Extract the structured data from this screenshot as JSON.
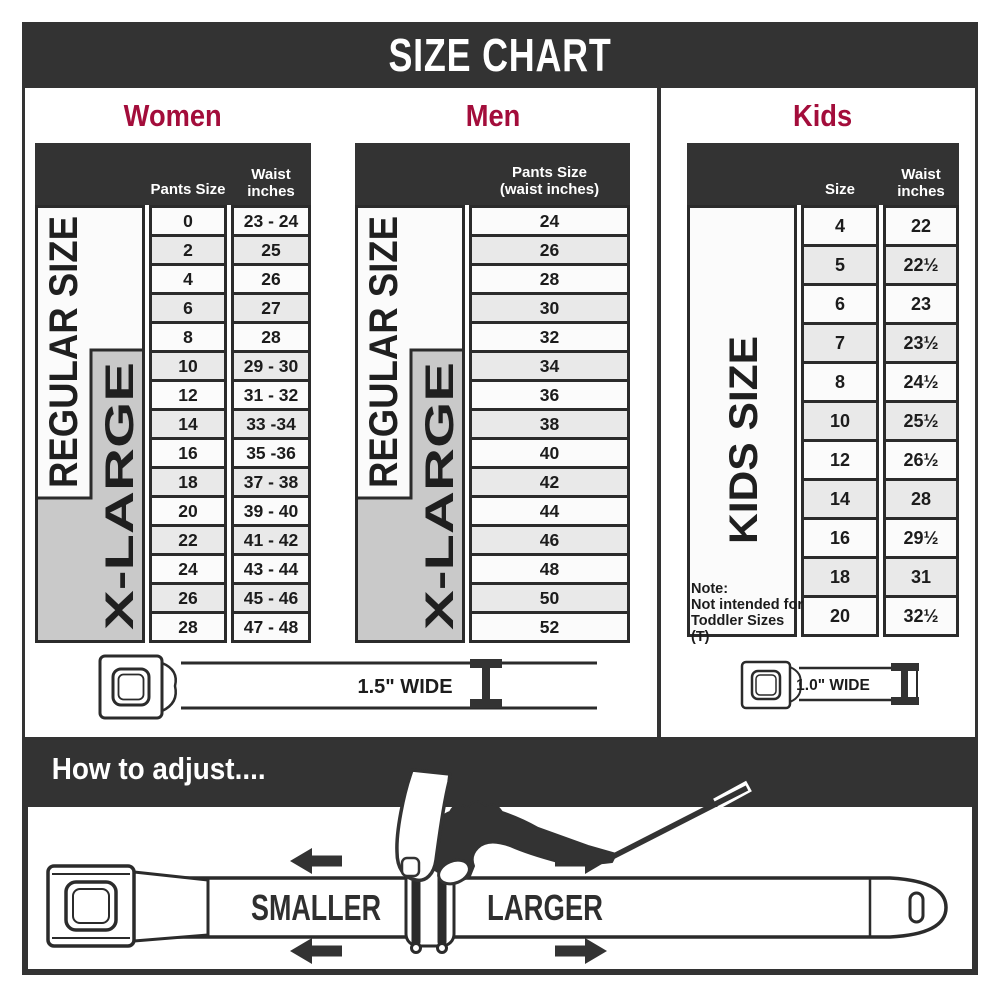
{
  "title": "SIZE CHART",
  "colors": {
    "dark": "#333333",
    "accent": "#a30d3b",
    "border": "#2b2b2b",
    "gray_band": "#c9c9c9",
    "row_bg": "#fbfbfb",
    "row_alt": "#e9e9e9"
  },
  "left_panel": {
    "belt_width_label": "1.5\" WIDE",
    "women": {
      "heading": "Women",
      "header": {
        "size": "Pants Size",
        "waist_line1": "Waist",
        "waist_line2": "inches"
      },
      "regular_label": "REGULAR SIZE",
      "xlarge_label": "X-LARGE",
      "rows": [
        {
          "size": "0",
          "waist": "23 - 24"
        },
        {
          "size": "2",
          "waist": "25"
        },
        {
          "size": "4",
          "waist": "26"
        },
        {
          "size": "6",
          "waist": "27"
        },
        {
          "size": "8",
          "waist": "28"
        },
        {
          "size": "10",
          "waist": "29 - 30"
        },
        {
          "size": "12",
          "waist": "31 - 32"
        },
        {
          "size": "14",
          "waist": "33 -34"
        },
        {
          "size": "16",
          "waist": "35 -36"
        },
        {
          "size": "18",
          "waist": "37 - 38"
        },
        {
          "size": "20",
          "waist": "39 - 40"
        },
        {
          "size": "22",
          "waist": "41 - 42"
        },
        {
          "size": "24",
          "waist": "43 - 44"
        },
        {
          "size": "26",
          "waist": "45 - 46"
        },
        {
          "size": "28",
          "waist": "47 - 48"
        }
      ]
    },
    "men": {
      "heading": "Men",
      "header": {
        "line1": "Pants Size",
        "line2": "(waist inches)"
      },
      "regular_label": "REGULAR SIZE",
      "xlarge_label": "X-LARGE",
      "rows": [
        {
          "size": "24"
        },
        {
          "size": "26"
        },
        {
          "size": "28"
        },
        {
          "size": "30"
        },
        {
          "size": "32"
        },
        {
          "size": "34"
        },
        {
          "size": "36"
        },
        {
          "size": "38"
        },
        {
          "size": "40"
        },
        {
          "size": "42"
        },
        {
          "size": "44"
        },
        {
          "size": "46"
        },
        {
          "size": "48"
        },
        {
          "size": "50"
        },
        {
          "size": "52"
        }
      ]
    }
  },
  "kids_panel": {
    "heading": "Kids",
    "belt_width_label": "1.0\" WIDE",
    "header": {
      "size": "Size",
      "waist_line1": "Waist",
      "waist_line2": "inches"
    },
    "side_label": "KIDS SIZE",
    "note": {
      "line1": "Note:",
      "line2": "Not intended for",
      "line3": "Toddler Sizes (T)"
    },
    "rows": [
      {
        "size": "4",
        "waist": "22"
      },
      {
        "size": "5",
        "waist": "22½"
      },
      {
        "size": "6",
        "waist": "23"
      },
      {
        "size": "7",
        "waist": "23½"
      },
      {
        "size": "8",
        "waist": "24½"
      },
      {
        "size": "10",
        "waist": "25½"
      },
      {
        "size": "12",
        "waist": "26½"
      },
      {
        "size": "14",
        "waist": "28"
      },
      {
        "size": "16",
        "waist": "29½"
      },
      {
        "size": "18",
        "waist": "31"
      },
      {
        "size": "20",
        "waist": "32½"
      }
    ]
  },
  "adjust": {
    "heading": "How to adjust....",
    "smaller": "SMALLER",
    "larger": "LARGER"
  }
}
